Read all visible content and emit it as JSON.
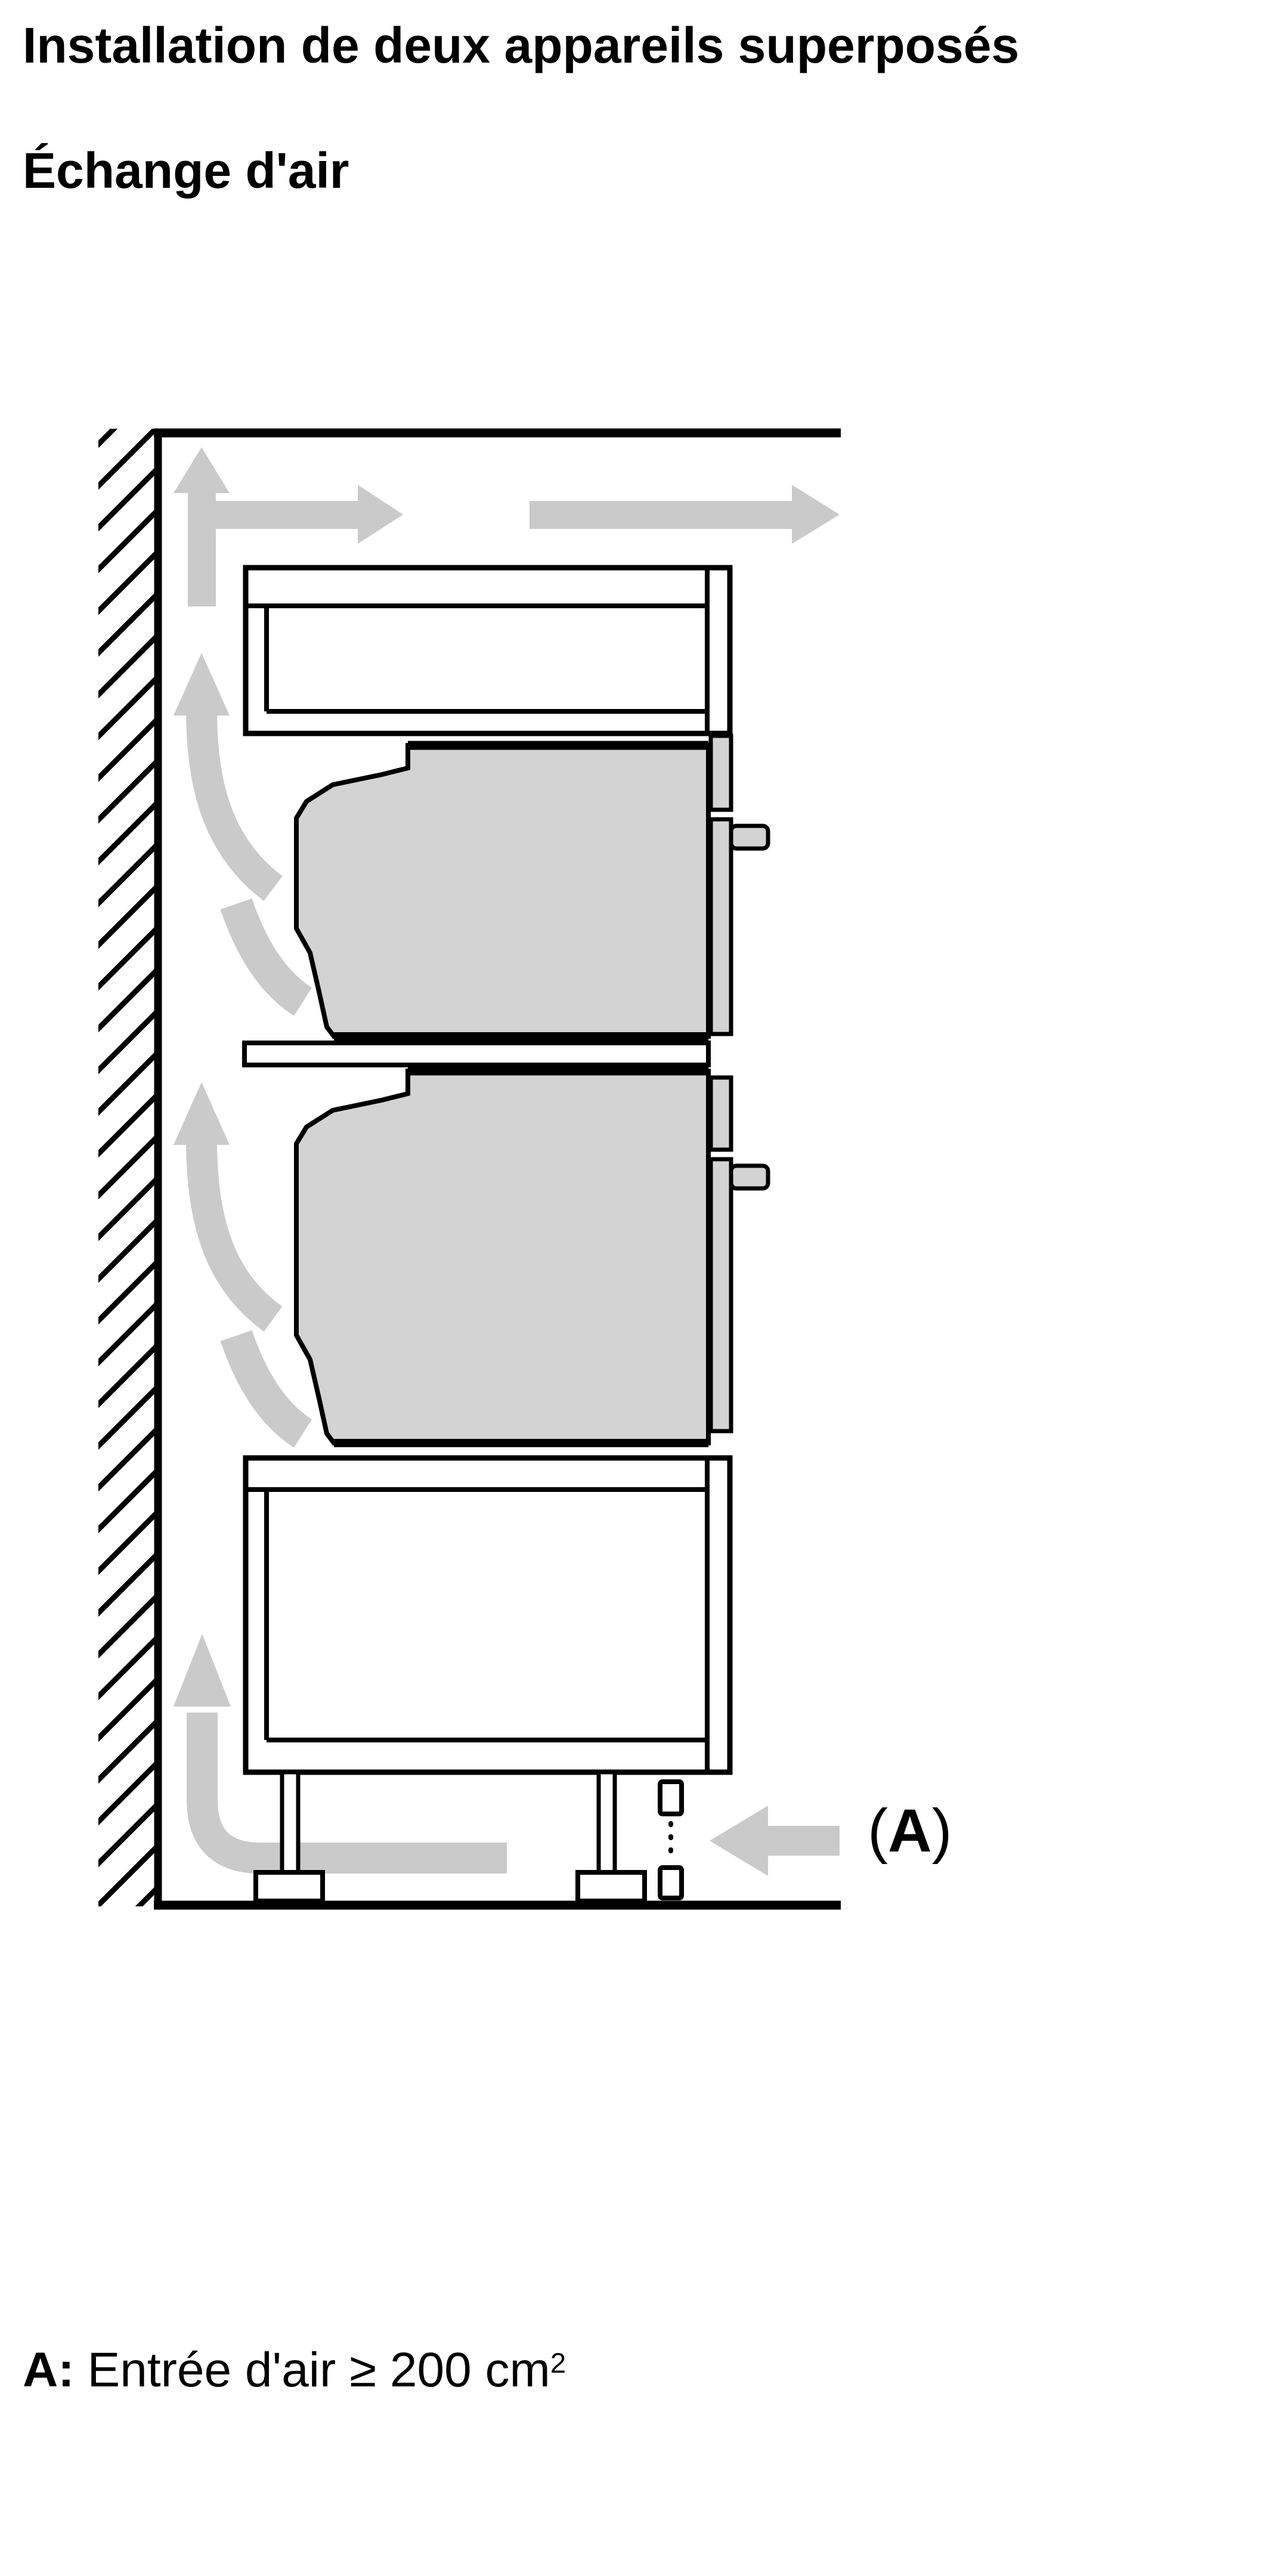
{
  "page": {
    "background": "#ffffff"
  },
  "header": {
    "title": "Installation de deux appareils superposés",
    "subtitle": "Échange d'air"
  },
  "diagram": {
    "label_a": {
      "open": "(",
      "letter": "A",
      "close": ")"
    },
    "colors": {
      "page_background": "#ffffff",
      "outline": "#000000",
      "appliance_fill": "#d3d3d3",
      "airflow_fill": "#cacaca",
      "cabinet_fill": "#ffffff"
    }
  },
  "legend": {
    "prefix": "A:",
    "text": "Entrée d'air ≥ 200 cm",
    "superscript": "2"
  }
}
